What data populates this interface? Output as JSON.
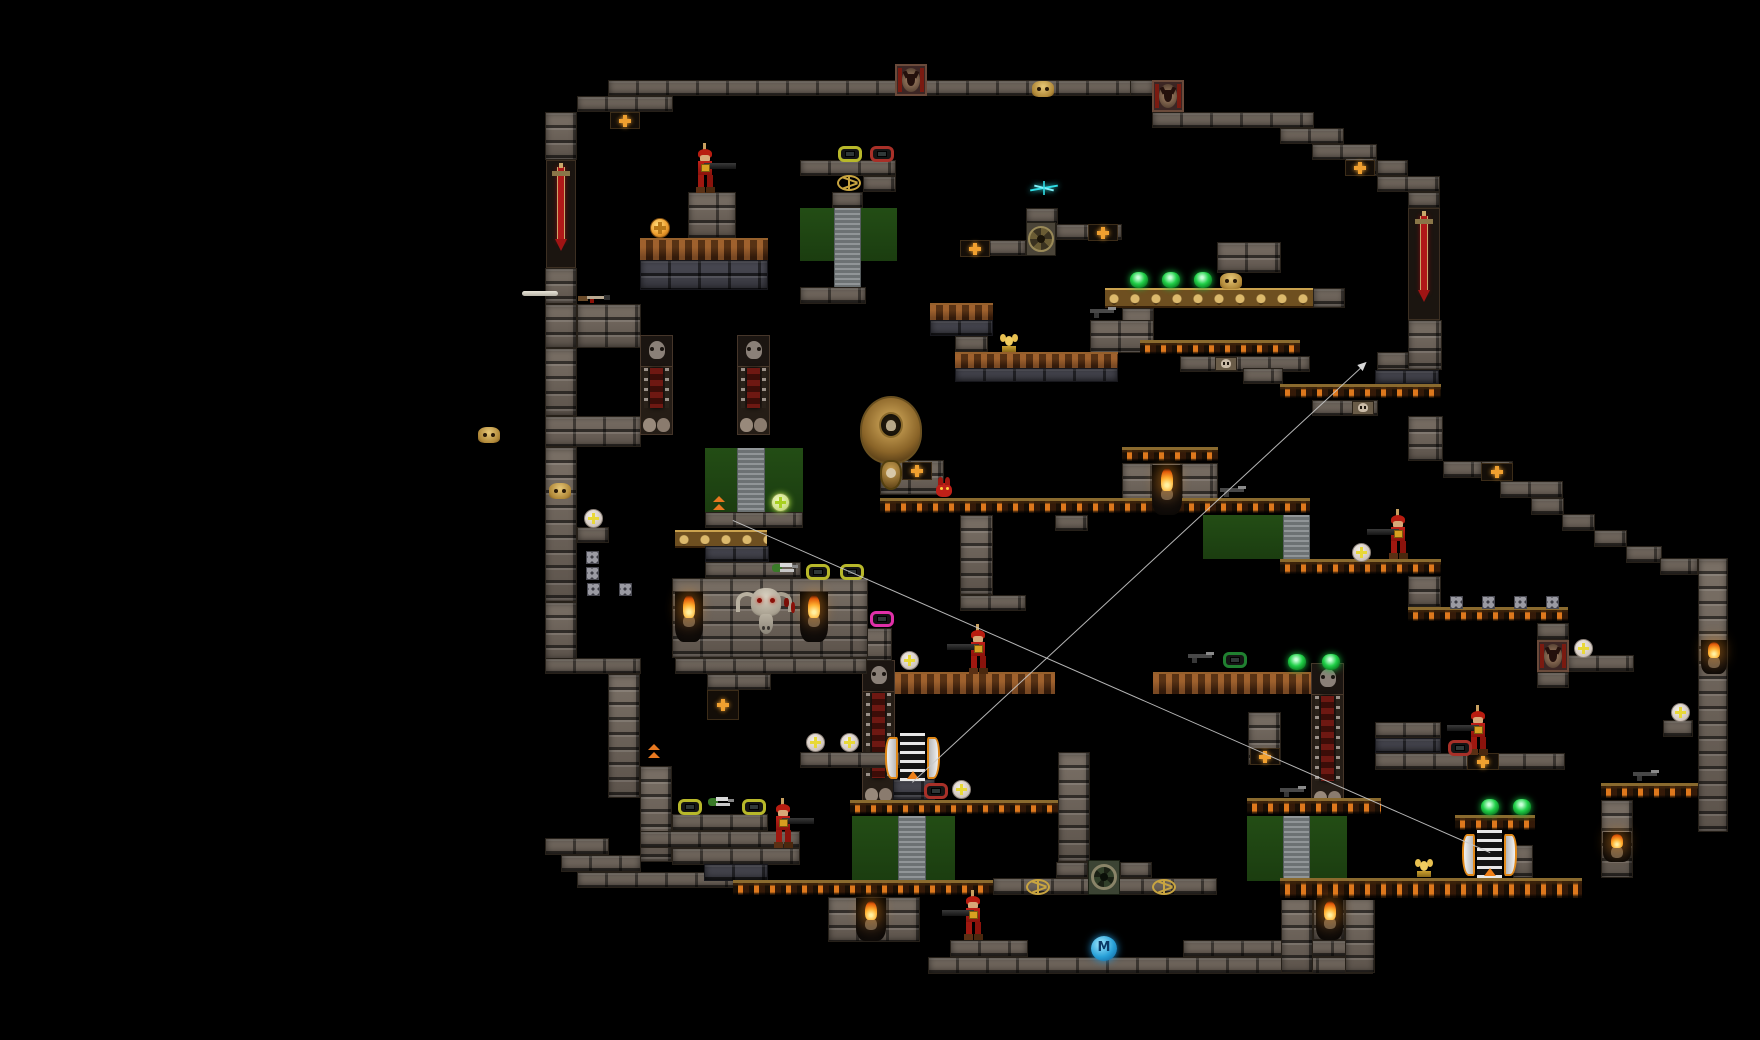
{
  "scene": {
    "width": 1760,
    "height": 1040,
    "background": "#000000"
  },
  "marker": {
    "label": "M"
  },
  "palette": {
    "brick": "#6d645b",
    "brick_dark": "#43434b",
    "skull_platform_slot": "#e87e1e",
    "gold": "#caa24e",
    "rust": "#5e3113",
    "green_door": "#1f4512",
    "grey_column": "#7e8486",
    "enemy_red": "#b81c10",
    "gem_green": "#20d048",
    "gem_yellow_frame": "#b8b82a",
    "gem_red_frame": "#a83028",
    "gem_magenta_frame": "#e030a8",
    "orb": "#e8e0d8",
    "cross_orange": "#f0a030",
    "flame": "#ff9820",
    "teleport_blue": "#28a0d8",
    "sparkle_cyan": "#30e0e8",
    "path_line": "#c9c9c9",
    "sword_red": "#b01818"
  },
  "platforms": [
    [
      608,
      80,
      528,
      16,
      "b"
    ],
    [
      577,
      96,
      96,
      16,
      "b"
    ],
    [
      545,
      112,
      32,
      48,
      "b"
    ],
    [
      546,
      160,
      30,
      108,
      "sw"
    ],
    [
      545,
      268,
      32,
      36,
      "b"
    ],
    [
      577,
      304,
      64,
      44,
      "b"
    ],
    [
      545,
      304,
      32,
      44,
      "b"
    ],
    [
      545,
      348,
      32,
      68,
      "b"
    ],
    [
      545,
      416,
      96,
      31,
      "b"
    ],
    [
      545,
      447,
      32,
      155,
      "b"
    ],
    [
      577,
      527,
      32,
      16,
      "b"
    ],
    [
      545,
      602,
      32,
      58,
      "b"
    ],
    [
      545,
      658,
      96,
      16,
      "b"
    ],
    [
      608,
      674,
      32,
      124,
      "b"
    ],
    [
      545,
      838,
      64,
      17,
      "b"
    ],
    [
      561,
      855,
      80,
      17,
      "b"
    ],
    [
      577,
      872,
      160,
      16,
      "b"
    ],
    [
      1130,
      80,
      24,
      16,
      "b"
    ],
    [
      1152,
      112,
      162,
      16,
      "b"
    ],
    [
      1280,
      128,
      64,
      16,
      "b"
    ],
    [
      1312,
      144,
      65,
      16,
      "b"
    ],
    [
      1345,
      158,
      32,
      18,
      "b"
    ],
    [
      1377,
      160,
      31,
      16,
      "b"
    ],
    [
      1377,
      176,
      63,
      16,
      "b"
    ],
    [
      1408,
      192,
      32,
      16,
      "b"
    ],
    [
      1408,
      208,
      32,
      112,
      "sw"
    ],
    [
      1408,
      320,
      34,
      50,
      "b"
    ],
    [
      1377,
      352,
      32,
      18,
      "b"
    ],
    [
      1375,
      370,
      64,
      14,
      "bd"
    ],
    [
      1280,
      384,
      161,
      16,
      "sk"
    ],
    [
      1312,
      400,
      66,
      16,
      "b"
    ],
    [
      1408,
      416,
      35,
      45,
      "b"
    ],
    [
      1443,
      461,
      39,
      17,
      "b"
    ],
    [
      1481,
      461,
      32,
      20,
      "b"
    ],
    [
      1500,
      481,
      63,
      17,
      "b"
    ],
    [
      1531,
      498,
      33,
      17,
      "b"
    ],
    [
      1562,
      514,
      33,
      17,
      "b"
    ],
    [
      1594,
      530,
      33,
      17,
      "b"
    ],
    [
      1626,
      546,
      36,
      17,
      "b"
    ],
    [
      1660,
      558,
      38,
      17,
      "b"
    ],
    [
      1698,
      558,
      30,
      274,
      "b"
    ],
    [
      640,
      238,
      128,
      22,
      "ru"
    ],
    [
      640,
      260,
      128,
      30,
      "bd"
    ],
    [
      688,
      192,
      48,
      46,
      "b"
    ],
    [
      800,
      160,
      96,
      16,
      "b"
    ],
    [
      863,
      176,
      33,
      16,
      "b"
    ],
    [
      832,
      192,
      31,
      16,
      "b"
    ],
    [
      800,
      208,
      97,
      53,
      "gp"
    ],
    [
      834,
      208,
      27,
      84,
      "gc"
    ],
    [
      800,
      287,
      66,
      17,
      "b"
    ],
    [
      960,
      240,
      66,
      16,
      "b"
    ],
    [
      1026,
      208,
      32,
      16,
      "b"
    ],
    [
      1056,
      224,
      66,
      16,
      "b"
    ],
    [
      1105,
      288,
      208,
      20,
      "gs"
    ],
    [
      1313,
      288,
      32,
      20,
      "b"
    ],
    [
      1217,
      242,
      64,
      31,
      "b"
    ],
    [
      1122,
      308,
      32,
      35,
      "b"
    ],
    [
      1090,
      320,
      64,
      33,
      "b"
    ],
    [
      930,
      303,
      63,
      17,
      "ru"
    ],
    [
      930,
      320,
      63,
      16,
      "bd"
    ],
    [
      955,
      336,
      33,
      16,
      "b"
    ],
    [
      955,
      352,
      163,
      16,
      "ru"
    ],
    [
      955,
      368,
      163,
      14,
      "bd"
    ],
    [
      1140,
      340,
      160,
      16,
      "sk"
    ],
    [
      1180,
      356,
      130,
      16,
      "b"
    ],
    [
      1243,
      368,
      40,
      16,
      "b"
    ],
    [
      1122,
      447,
      96,
      16,
      "sk"
    ],
    [
      1122,
      463,
      96,
      52,
      "b"
    ],
    [
      880,
      498,
      430,
      17,
      "sk"
    ],
    [
      960,
      515,
      33,
      80,
      "b"
    ],
    [
      960,
      595,
      66,
      16,
      "b"
    ],
    [
      1055,
      515,
      33,
      16,
      "b"
    ],
    [
      1203,
      515,
      81,
      44,
      "gp"
    ],
    [
      1283,
      515,
      27,
      44,
      "gc"
    ],
    [
      880,
      460,
      64,
      35,
      "b"
    ],
    [
      1280,
      559,
      161,
      17,
      "sk"
    ],
    [
      1408,
      576,
      33,
      31,
      "b"
    ],
    [
      1408,
      607,
      160,
      16,
      "sk"
    ],
    [
      1537,
      623,
      32,
      17,
      "b"
    ],
    [
      1537,
      672,
      32,
      16,
      "b"
    ],
    [
      1568,
      655,
      66,
      17,
      "b"
    ],
    [
      1153,
      672,
      158,
      22,
      "ru"
    ],
    [
      895,
      672,
      160,
      22,
      "ru"
    ],
    [
      1311,
      663,
      33,
      145,
      "oc"
    ],
    [
      862,
      660,
      33,
      145,
      "oc"
    ],
    [
      640,
      335,
      33,
      100,
      "oc"
    ],
    [
      737,
      335,
      33,
      100,
      "oc"
    ],
    [
      856,
      628,
      36,
      33,
      "b"
    ],
    [
      705,
      448,
      98,
      64,
      "gp"
    ],
    [
      737,
      448,
      28,
      64,
      "gc"
    ],
    [
      705,
      512,
      98,
      16,
      "b"
    ],
    [
      675,
      530,
      92,
      18,
      "gs"
    ],
    [
      705,
      546,
      64,
      16,
      "bd"
    ],
    [
      705,
      562,
      96,
      16,
      "b"
    ],
    [
      672,
      578,
      196,
      80,
      "b"
    ],
    [
      675,
      658,
      192,
      16,
      "b"
    ],
    [
      707,
      674,
      64,
      16,
      "b"
    ],
    [
      800,
      752,
      100,
      16,
      "b"
    ],
    [
      640,
      766,
      32,
      96,
      "b"
    ],
    [
      672,
      814,
      96,
      17,
      "b"
    ],
    [
      640,
      831,
      160,
      17,
      "b"
    ],
    [
      672,
      848,
      128,
      17,
      "b"
    ],
    [
      704,
      864,
      64,
      17,
      "bd"
    ],
    [
      733,
      880,
      327,
      17,
      "sk"
    ],
    [
      828,
      897,
      92,
      45,
      "b"
    ],
    [
      893,
      779,
      42,
      21,
      "bd"
    ],
    [
      850,
      800,
      215,
      16,
      "sk"
    ],
    [
      852,
      816,
      103,
      64,
      "gp"
    ],
    [
      898,
      816,
      28,
      64,
      "gc"
    ],
    [
      1058,
      752,
      32,
      110,
      "b"
    ],
    [
      993,
      878,
      224,
      17,
      "b"
    ],
    [
      1056,
      862,
      32,
      16,
      "b"
    ],
    [
      1120,
      862,
      32,
      16,
      "b"
    ],
    [
      950,
      940,
      78,
      17,
      "b"
    ],
    [
      1183,
      940,
      188,
      17,
      "b"
    ],
    [
      928,
      957,
      445,
      17,
      "b"
    ],
    [
      1247,
      798,
      134,
      18,
      "sk"
    ],
    [
      1247,
      816,
      100,
      65,
      "gp"
    ],
    [
      1283,
      816,
      27,
      65,
      "gc"
    ],
    [
      1281,
      897,
      32,
      76,
      "b"
    ],
    [
      1313,
      897,
      32,
      43,
      "b"
    ],
    [
      1345,
      897,
      30,
      76,
      "b"
    ],
    [
      1248,
      712,
      33,
      53,
      "b"
    ],
    [
      1375,
      722,
      66,
      16,
      "b"
    ],
    [
      1375,
      738,
      66,
      15,
      "bd"
    ],
    [
      1375,
      753,
      190,
      17,
      "b"
    ],
    [
      1455,
      815,
      80,
      17,
      "sk"
    ],
    [
      1513,
      845,
      20,
      33,
      "b"
    ],
    [
      1280,
      878,
      302,
      22,
      "sk"
    ],
    [
      1601,
      783,
      97,
      17,
      "sk"
    ],
    [
      1601,
      800,
      32,
      78,
      "b"
    ],
    [
      1663,
      720,
      30,
      17,
      "b"
    ]
  ],
  "sprites": [
    [
      "goat",
      895,
      64
    ],
    [
      "goat",
      1152,
      80
    ],
    [
      "goat",
      1537,
      640
    ],
    [
      "xtile",
      610,
      112,
      30,
      17
    ],
    [
      "xtile",
      1345,
      160,
      30,
      16
    ],
    [
      "xtile",
      1088,
      224,
      30,
      17
    ],
    [
      "xtile",
      960,
      240,
      30,
      17
    ],
    [
      "xtile",
      1481,
      463,
      32,
      18
    ],
    [
      "xtile",
      902,
      462,
      30,
      18
    ],
    [
      "xtile",
      707,
      690,
      32,
      30
    ],
    [
      "xtile",
      1250,
      748,
      30,
      17
    ],
    [
      "xtile",
      1467,
      753,
      32,
      17
    ],
    [
      "gskull",
      1032,
      81
    ],
    [
      "gskull",
      478,
      427
    ],
    [
      "gskull",
      549,
      483
    ],
    [
      "gskull",
      1220,
      273
    ],
    [
      "sface",
      1215,
      357
    ],
    [
      "sface",
      1352,
      401
    ],
    [
      "pent",
      835,
      175
    ],
    [
      "pent",
      1024,
      879
    ],
    [
      "pent",
      1150,
      879
    ],
    [
      "gear",
      1026,
      222
    ],
    [
      "port",
      1088,
      860
    ],
    [
      "bull",
      734,
      586
    ],
    [
      "cobra",
      860,
      396
    ],
    [
      "torch",
      675,
      592,
      28,
      50
    ],
    [
      "torch",
      800,
      592,
      28,
      50
    ],
    [
      "torch",
      1152,
      465,
      30,
      50
    ],
    [
      "torch",
      856,
      898,
      30,
      43
    ],
    [
      "torch",
      1316,
      898,
      27,
      42
    ],
    [
      "torch",
      1603,
      832,
      28,
      30
    ],
    [
      "torch",
      1701,
      640,
      26,
      34
    ],
    [
      "sold",
      690,
      146,
      1
    ],
    [
      "sold",
      963,
      627,
      -1
    ],
    [
      "sold",
      1383,
      512,
      -1
    ],
    [
      "sold",
      1463,
      708,
      -1
    ],
    [
      "sold",
      768,
      801,
      1
    ],
    [
      "sold",
      958,
      893,
      -1
    ],
    [
      "imp",
      933,
      477
    ],
    [
      "gemg",
      1130,
      272
    ],
    [
      "gemg",
      1162,
      272
    ],
    [
      "gemg",
      1194,
      272
    ],
    [
      "gemg",
      1288,
      654
    ],
    [
      "gemg",
      1322,
      654
    ],
    [
      "gemg",
      1481,
      799
    ],
    [
      "gemg",
      1513,
      799
    ],
    [
      "gemf",
      838,
      146,
      "y"
    ],
    [
      "gemf",
      678,
      799,
      "y"
    ],
    [
      "gemf",
      742,
      799,
      "y"
    ],
    [
      "gemf",
      806,
      564,
      "y"
    ],
    [
      "gemf",
      840,
      564,
      "y"
    ],
    [
      "gemf",
      870,
      146,
      "r"
    ],
    [
      "gemf",
      924,
      783,
      "r"
    ],
    [
      "gemf",
      1448,
      740,
      "r"
    ],
    [
      "gemf",
      870,
      611,
      "m"
    ],
    [
      "gemf",
      1223,
      652,
      "g2"
    ],
    [
      "orb",
      584,
      509
    ],
    [
      "orb",
      806,
      733
    ],
    [
      "orb",
      840,
      733
    ],
    [
      "orb",
      900,
      651
    ],
    [
      "orb",
      952,
      780
    ],
    [
      "orb",
      1352,
      543
    ],
    [
      "orb",
      1574,
      639
    ],
    [
      "orb",
      1671,
      703
    ],
    [
      "orbg",
      771,
      493
    ],
    [
      "coin",
      650,
      218
    ],
    [
      "idol",
      998,
      334
    ],
    [
      "idol",
      1413,
      859
    ],
    [
      "pad",
      885,
      733
    ],
    [
      "pad",
      1462,
      830
    ],
    [
      "arrows",
      646,
      744
    ],
    [
      "arrows",
      711,
      496
    ],
    [
      "vent",
      586,
      551
    ],
    [
      "vent",
      586,
      567
    ],
    [
      "vent",
      587,
      583
    ],
    [
      "vent",
      619,
      583
    ],
    [
      "vent",
      1450,
      596
    ],
    [
      "vent",
      1482,
      596
    ],
    [
      "vent",
      1514,
      596
    ],
    [
      "vent",
      1546,
      596
    ],
    [
      "mball",
      1091,
      936
    ],
    [
      "blood",
      782,
      598
    ],
    [
      "bone",
      522,
      290
    ],
    [
      "spark",
      1030,
      180
    ],
    [
      "wpn",
      578,
      293,
      "shot"
    ],
    [
      "wpn",
      706,
      796,
      "green"
    ],
    [
      "wpn",
      770,
      562,
      "green"
    ],
    [
      "wpn",
      1090,
      307,
      "gun"
    ],
    [
      "wpn",
      1188,
      652,
      "gun"
    ],
    [
      "wpn",
      1220,
      486,
      "gun"
    ],
    [
      "wpn",
      1633,
      770,
      "gun"
    ],
    [
      "wpn",
      1280,
      786,
      "gun"
    ]
  ],
  "lines": [
    {
      "x1": 733,
      "y1": 520,
      "x2": 1490,
      "y2": 852,
      "arrow": false
    },
    {
      "x1": 912,
      "y1": 782,
      "x2": 1360,
      "y2": 368,
      "arrow": true
    }
  ]
}
